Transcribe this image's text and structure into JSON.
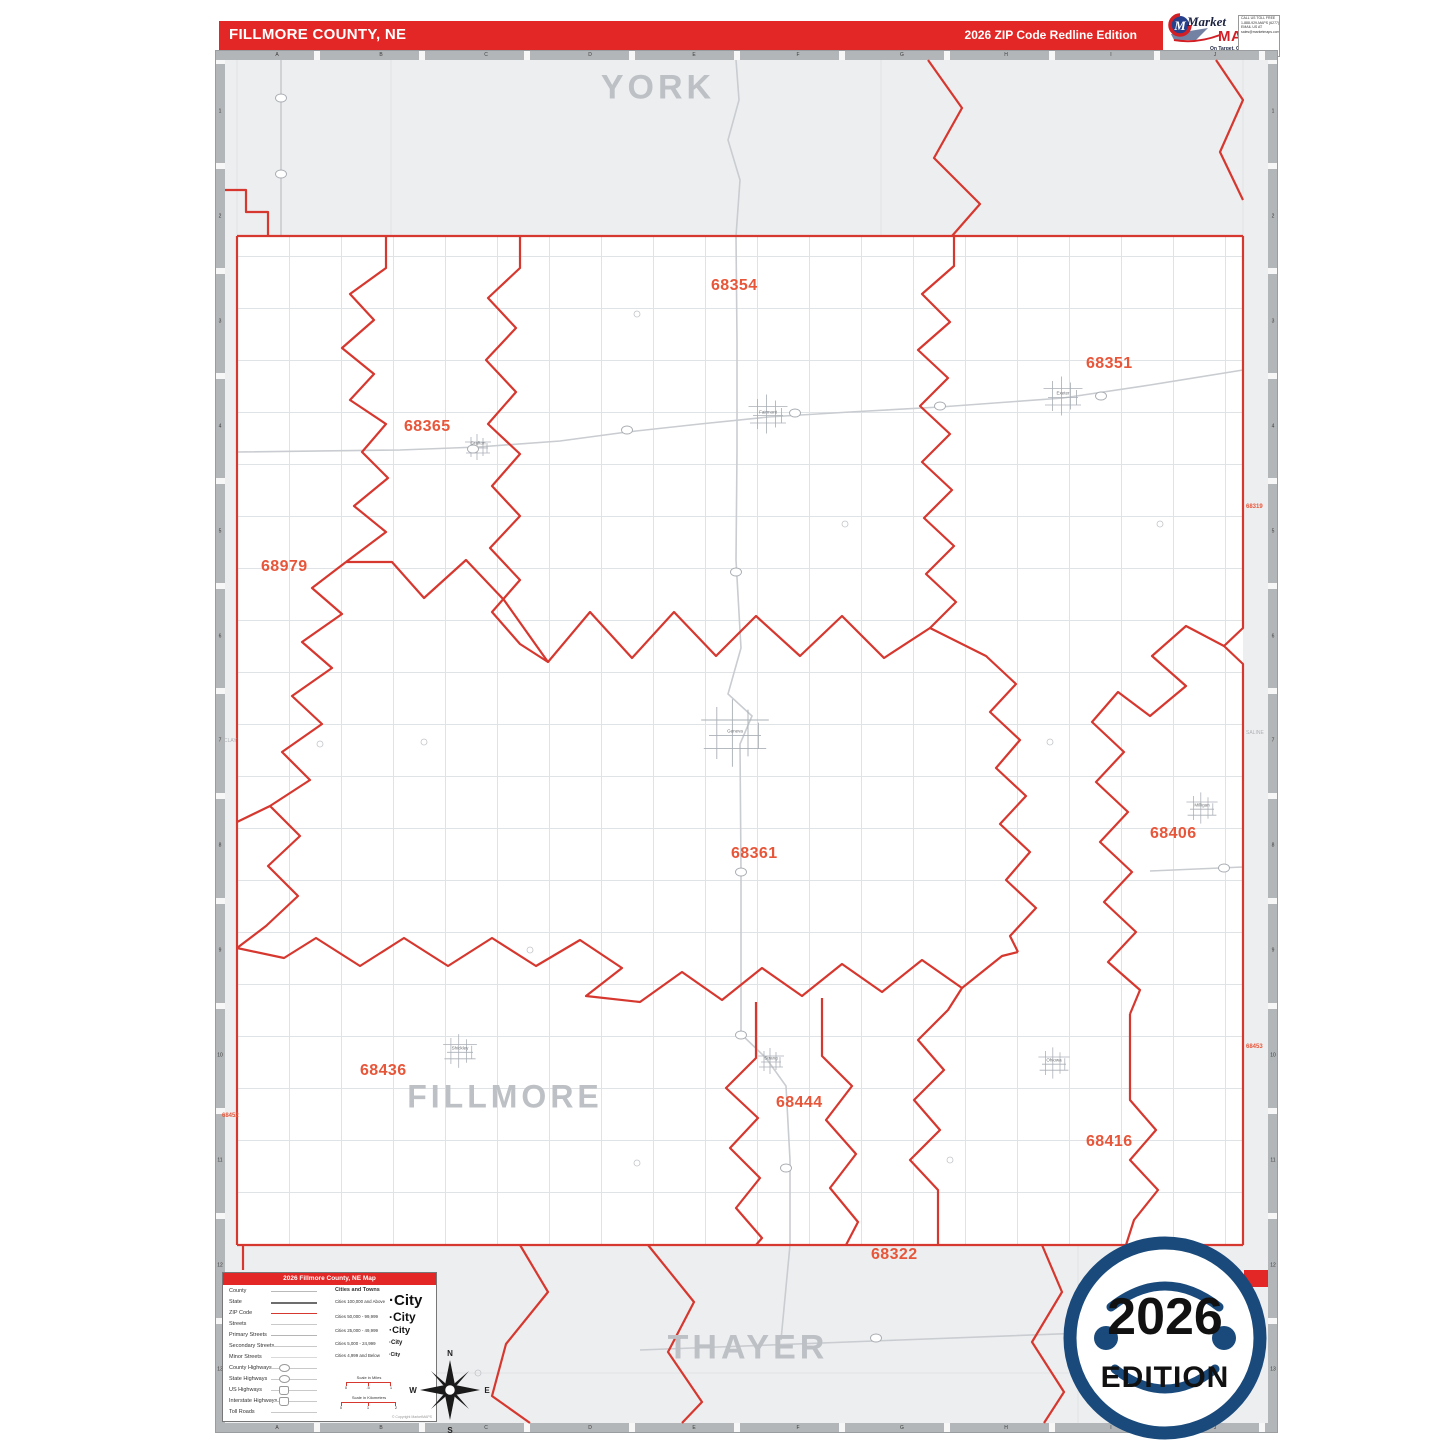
{
  "header": {
    "title": "FILLMORE COUNTY, NE",
    "edition": "2026 ZIP Code Redline Edition"
  },
  "logo": {
    "market": "Market",
    "maps": "MAPS",
    "emblem_letter": "M",
    "tagline": "On Target.  On Time.",
    "subtitle": "America's Leading Source of Business Maps",
    "contact": [
      "CALL US TOLL FREE",
      "1-888-929-MAPS (6277)",
      "EMAIL US AT",
      "sales@marketmaps.com"
    ],
    "product_code": "D123456"
  },
  "map": {
    "grid_columns": [
      "A",
      "B",
      "C",
      "D",
      "E",
      "F",
      "G",
      "H",
      "I",
      "J"
    ],
    "grid_rows": [
      "1",
      "2",
      "3",
      "4",
      "5",
      "6",
      "7",
      "8",
      "9",
      "10",
      "11",
      "12",
      "13"
    ],
    "neighbors": {
      "north": "YORK",
      "south": "THAYER",
      "west": "CLAY",
      "east": "SALINE",
      "county": "FILLMORE"
    },
    "zip_labels": [
      {
        "code": "68354"
      },
      {
        "code": "68365"
      },
      {
        "code": "68351"
      },
      {
        "code": "68979"
      },
      {
        "code": "68361"
      },
      {
        "code": "68406"
      },
      {
        "code": "68436"
      },
      {
        "code": "68444"
      },
      {
        "code": "68416"
      },
      {
        "code": "68322"
      }
    ],
    "edge_zips": [
      {
        "code": "68319"
      },
      {
        "code": "68452"
      },
      {
        "code": "68453"
      }
    ],
    "towns": [
      {
        "name": "Grafton"
      },
      {
        "name": "Fairmont"
      },
      {
        "name": "Exeter"
      },
      {
        "name": "Geneva"
      },
      {
        "name": "Milligan"
      },
      {
        "name": "Shickley"
      },
      {
        "name": "Strang"
      },
      {
        "name": "Ohiowa"
      }
    ]
  },
  "legend": {
    "title": "2026 Fillmore County, NE Map",
    "line_items": [
      "County",
      "State",
      "ZIP Code",
      "Streets",
      "Primary Streets",
      "Secondary Streets",
      "Minor Streets",
      "County Highways",
      "State Highways",
      "US Highways",
      "Interstate Highways",
      "Toll Roads"
    ],
    "cities_header": "Cities and Towns",
    "city_rows": [
      {
        "label": "Cities 100,000 and Above",
        "sample": "·City"
      },
      {
        "label": "Cities 50,000 - 99,999",
        "sample": "·City"
      },
      {
        "label": "Cities 25,000 - 49,999",
        "sample": "·City"
      },
      {
        "label": "Cities 5,000 - 24,999",
        "sample": "·City"
      },
      {
        "label": "Cities 4,999 and Below",
        "sample": "·City"
      }
    ],
    "scale_miles": {
      "label": "Scale in Miles",
      "ticks": [
        "0",
        ".5",
        "1"
      ]
    },
    "scale_km": {
      "label": "Scale in Kilometers",
      "ticks": [
        "0",
        "1",
        "2"
      ]
    },
    "copyright": "© Copyright MarketMAPS"
  },
  "badge": {
    "year": "2026",
    "word": "EDITION"
  },
  "compass": {
    "n": "N",
    "e": "E",
    "s": "S",
    "w": "W"
  },
  "colors": {
    "bar_red": "#e32726",
    "zip_label_orange": "#e8563a",
    "zip_line_red": "#d6372e",
    "badge_navy": "#194a7b",
    "neighbor_gray": "#bdc0c4"
  }
}
